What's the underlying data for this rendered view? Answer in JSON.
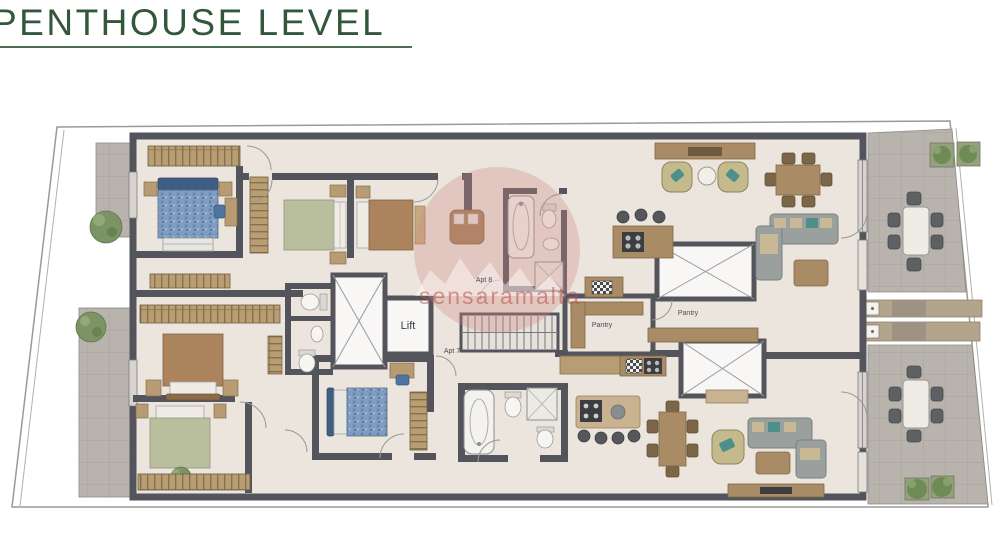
{
  "title": {
    "text": "PENTHOUSE LEVEL"
  },
  "watermark": {
    "text": "sensaramalta"
  },
  "labels": {
    "lift": "Lift",
    "apt8": "Apt 8",
    "apt7": "Apt 7",
    "pantry_left": "Pantry",
    "pantry_mid": "Pantry"
  },
  "colors": {
    "title_green": "#33573b",
    "wall_gray": "#54555c",
    "floor_cream": "#ebe5dd",
    "terrace_gray": "#b8b4ad",
    "wood_brown": "#a98c65",
    "wardrobe_tan": "#b99e74",
    "sofa_gray": "#9aa09e",
    "accent_teal": "#4e8f8a",
    "bed_blue": "#7d9cc0",
    "bed_green": "#b9bf9e",
    "bed_brown": "#ab845d",
    "plant_green": "#7c9363",
    "watermark_pink": "#c4625e"
  }
}
